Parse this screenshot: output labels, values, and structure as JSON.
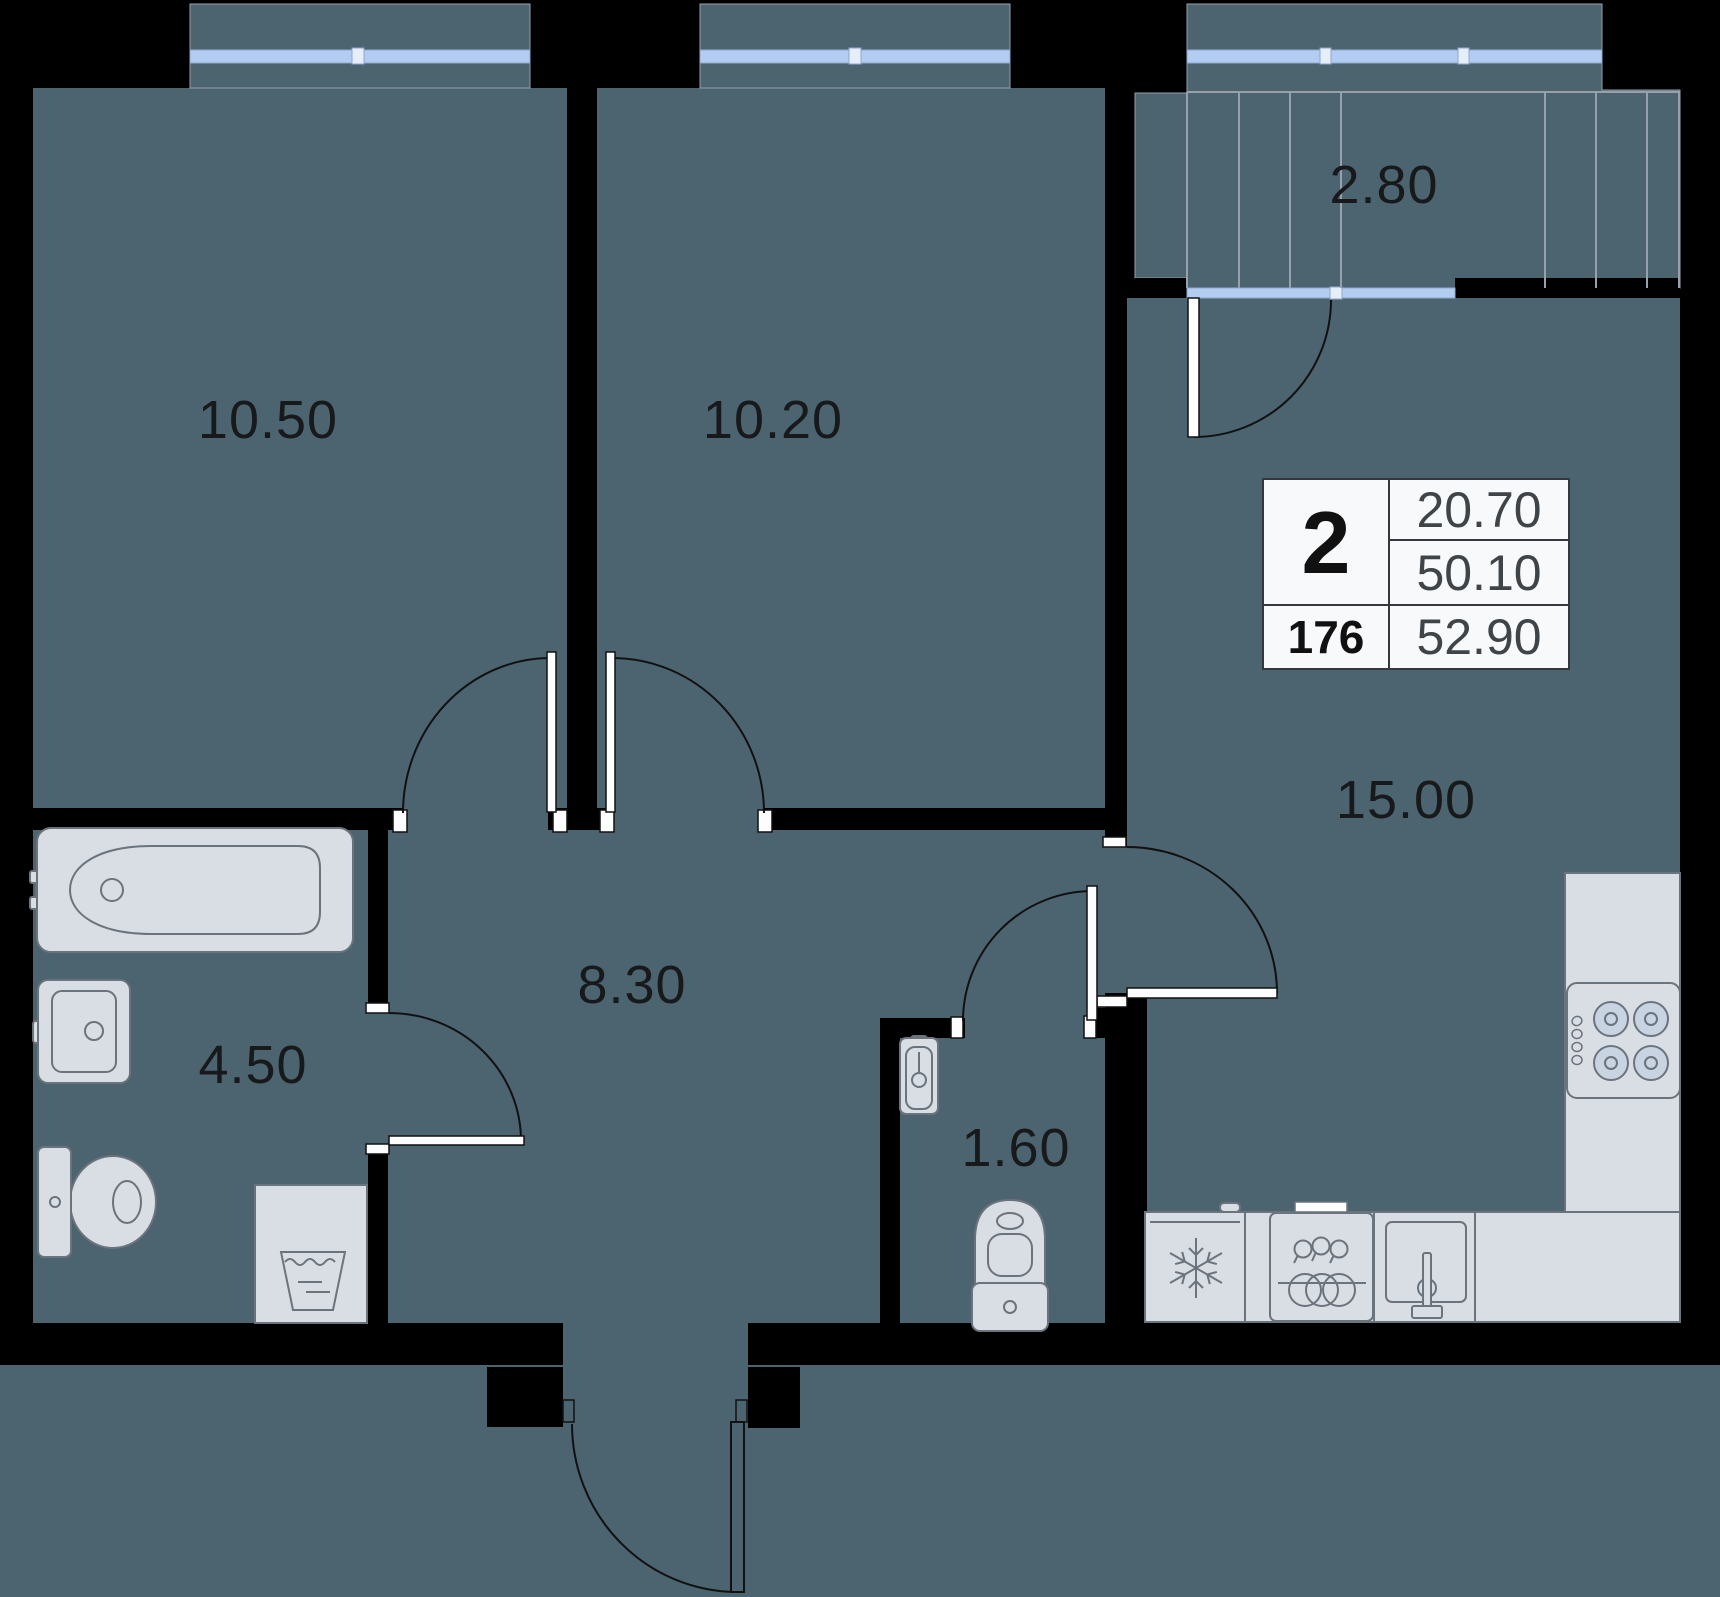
{
  "plan": {
    "type": "apartment-floor-plan",
    "rooms": [
      {
        "name": "bedroom-1",
        "area": "10.50"
      },
      {
        "name": "bedroom-2",
        "area": "10.20"
      },
      {
        "name": "balcony",
        "area": "2.80"
      },
      {
        "name": "kitchen-living-room",
        "area": "15.00"
      },
      {
        "name": "bathroom",
        "area": "4.50"
      },
      {
        "name": "hallway",
        "area": "8.30"
      },
      {
        "name": "wc",
        "area": "1.60"
      }
    ],
    "info_table": {
      "rooms_count": "2",
      "unit_number": "176",
      "living_area": "20.70",
      "apartment_area": "50.10",
      "total_area": "52.90"
    },
    "fixtures": [
      "bathtub",
      "washbasin",
      "toilet",
      "washing-machine",
      "wc-washbasin",
      "wc-toilet",
      "fridge",
      "dishwasher",
      "kitchen-sink",
      "stove",
      "kitchen-counter"
    ],
    "colors": {
      "room": "#4c646f",
      "wall": "#000000",
      "glass": "#b3cdf2",
      "glass-frame": "#e7eef9",
      "fixture": "#d9dee5",
      "fixture-stroke": "#6b737c",
      "line": "#111111",
      "mullion": "#97a1ab",
      "label": "#17191b",
      "table-bg": "#f8f9fa",
      "table-border": "#34383c",
      "table-text": "#3f4449",
      "table-bold": "#111111"
    }
  }
}
